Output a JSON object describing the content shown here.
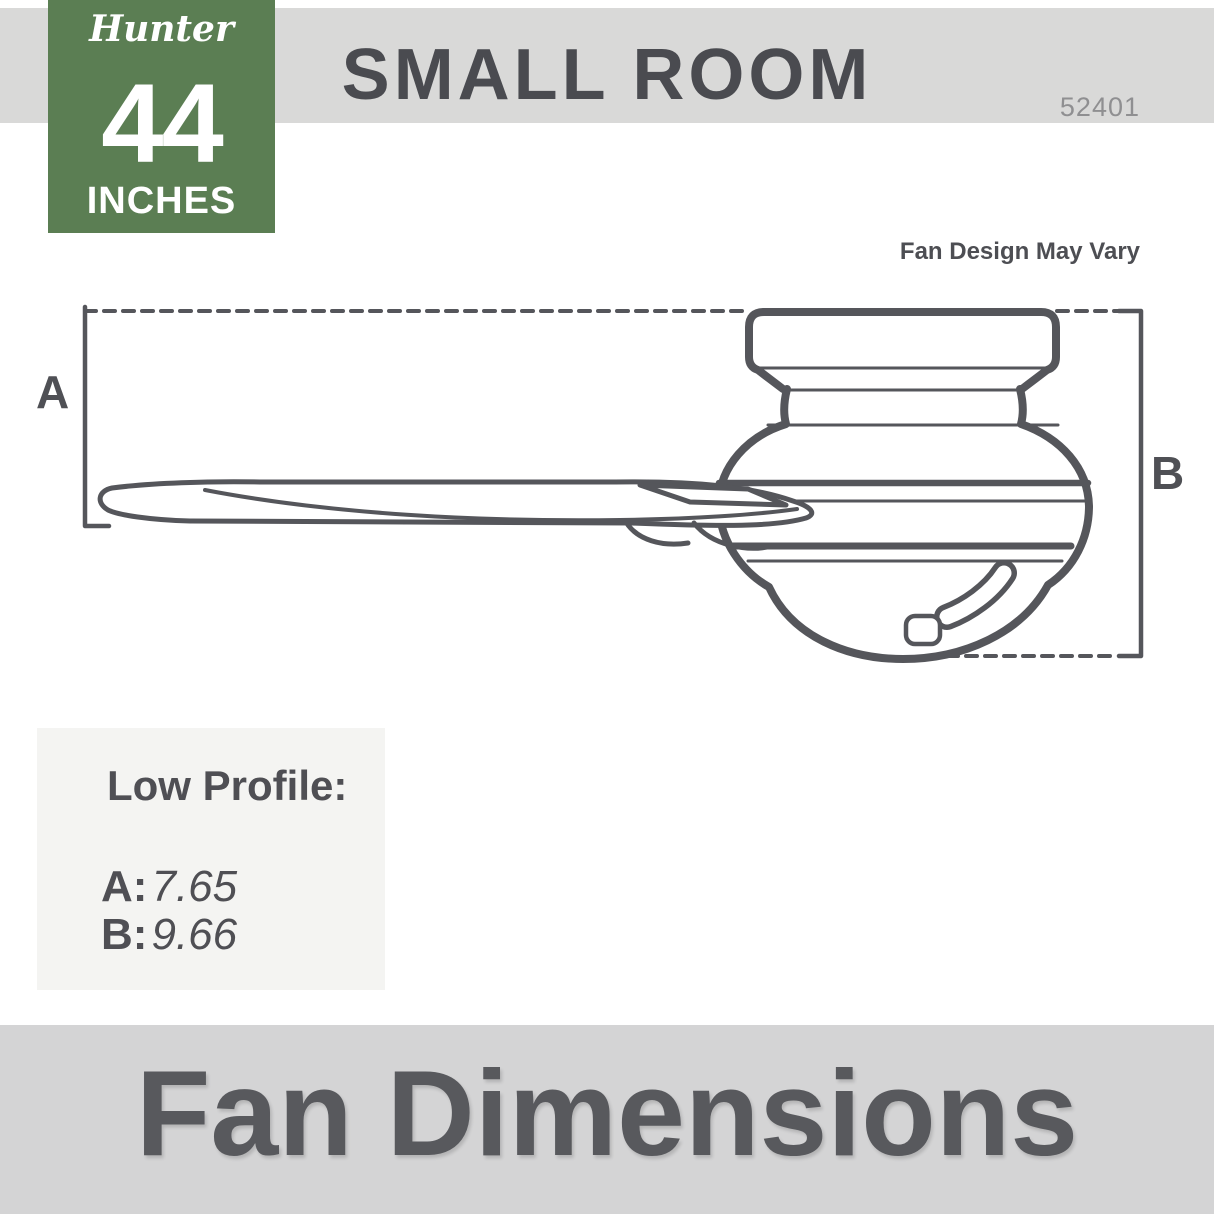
{
  "brand_badge": {
    "brand": "Hunter",
    "size_value": "44",
    "size_unit": "INCHES",
    "bg_color": "#5b7e53"
  },
  "header": {
    "title": "SMALL ROOM",
    "model_number": "52401",
    "bar_color": "#d9d9d8"
  },
  "diagram": {
    "note": "Fan Design May Vary",
    "dim_a_label": "A",
    "dim_b_label": "B",
    "line_color": "#55565b"
  },
  "specs": {
    "heading": "Low Profile:",
    "rows": [
      {
        "label": "A:",
        "value": "7.65"
      },
      {
        "label": "B:",
        "value": "9.66"
      }
    ],
    "box_color": "#f4f4f2"
  },
  "footer": {
    "title": "Fan Dimensions",
    "bar_color": "#d4d4d5",
    "text_color": "#58595d"
  }
}
